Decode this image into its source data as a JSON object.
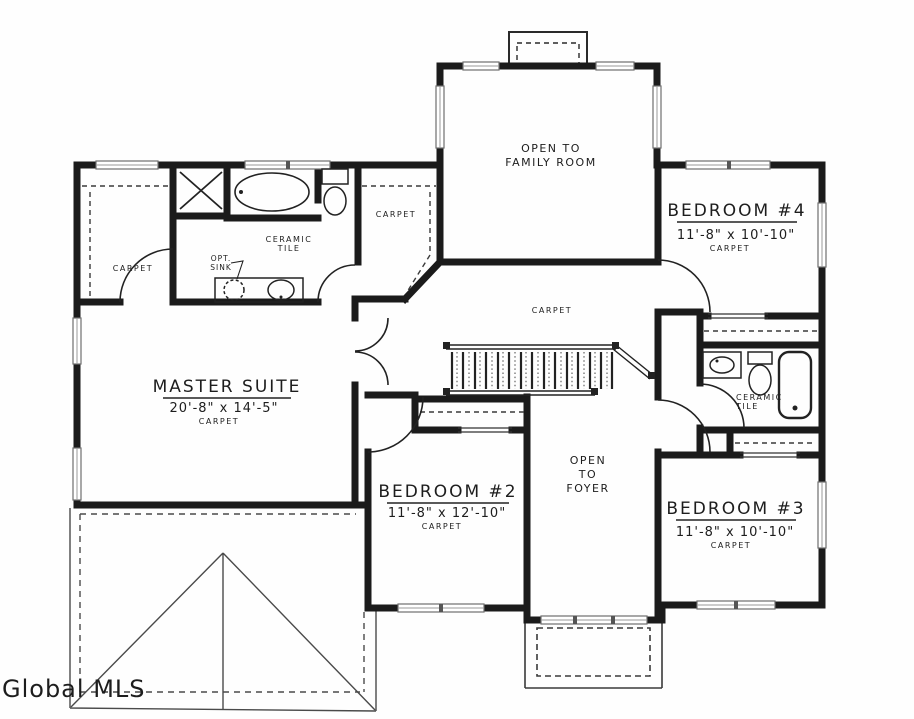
{
  "watermark": {
    "text": "Global MLS",
    "color": "#8f8f8f"
  },
  "colors": {
    "wall": "#1b1b1b",
    "window_frame": "#6e6e6e",
    "roof_line": "#4a4a4a"
  },
  "rooms": {
    "family_room": {
      "line1": "OPEN TO",
      "line2": "FAMILY ROOM"
    },
    "bedroom4": {
      "name": "BEDROOM #4",
      "dims": "11'-8\" x 10'-10\"",
      "floor": "CARPET"
    },
    "master_suite": {
      "name": "MASTER SUITE",
      "dims": "20'-8\" x 14'-5\"",
      "floor": "CARPET"
    },
    "bedroom2": {
      "name": "BEDROOM #2",
      "dims": "11'-8\" x 12'-10\"",
      "floor": "CARPET"
    },
    "bedroom3": {
      "name": "BEDROOM #3",
      "dims": "11'-8\" x 10'-10\"",
      "floor": "CARPET"
    },
    "foyer": {
      "line1": "OPEN",
      "line2": "TO",
      "line3": "FOYER"
    },
    "hallway": {
      "floor": "CARPET"
    },
    "master_bath": {
      "material_line1": "CERAMIC",
      "material_line2": "TILE",
      "opt_sink_line1": "OPT.",
      "opt_sink_line2": "SINK",
      "wic_floor": "CARPET",
      "closet_floor": "CARPET"
    },
    "hall_bath": {
      "material_line1": "CERAMIC",
      "material_line2": "TILE"
    }
  }
}
